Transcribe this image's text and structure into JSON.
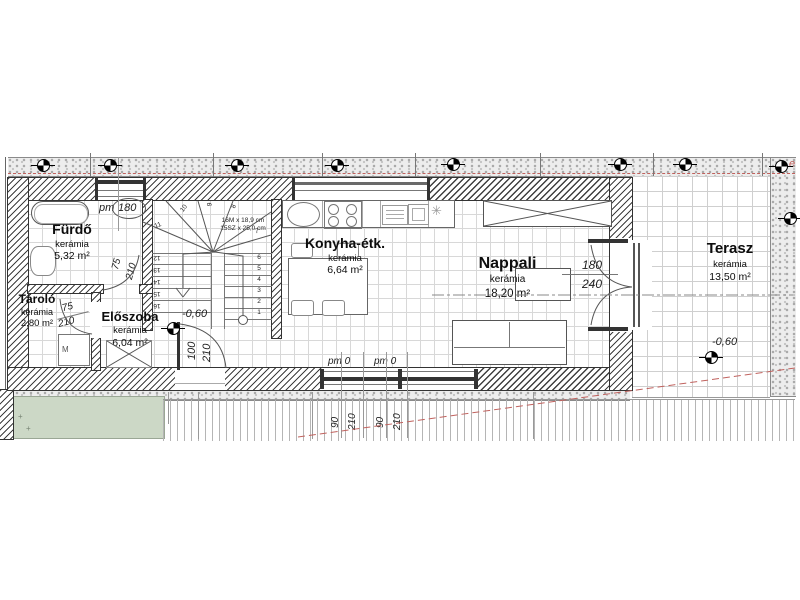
{
  "rooms": {
    "furdo": {
      "name": "Fürdő",
      "material": "kerámia",
      "area": "5,32 m²"
    },
    "tarolo": {
      "name": "Tároló",
      "material": "kerámia",
      "area": "2,80 m²"
    },
    "eloszoba": {
      "name": "Előszoba",
      "material": "kerámia",
      "area": "6,04 m²"
    },
    "konyha": {
      "name": "Konyha-étk.",
      "material": "kerámia",
      "area": "6,64 m²"
    },
    "nappali": {
      "name": "Nappali",
      "material": "kerámia",
      "area": "18,20 m²"
    },
    "terasz": {
      "name": "Terasz",
      "material": "kerámia",
      "area": "13,50 m²"
    }
  },
  "stairs": {
    "spec_line1": "16M x 18,9 cm",
    "spec_line2": "15SZ x 25,0 cm",
    "right_numbers": [
      "6",
      "5",
      "4",
      "3",
      "2",
      "1"
    ],
    "left_numbers": [
      "12",
      "13",
      "14",
      "15",
      "16"
    ],
    "winder_numbers": [
      "7",
      "8",
      "9",
      "10",
      "11"
    ]
  },
  "dimensions": {
    "top_window": {
      "prefix": "pm",
      "value": "180"
    },
    "bathroom_door": {
      "width": "75",
      "height": "210"
    },
    "storage_door": {
      "width": "75",
      "height": "210"
    },
    "entry_door": {
      "width": "100",
      "height": "210"
    },
    "window1": {
      "parapet": "pm 0",
      "width": "90",
      "height": "210"
    },
    "window2": {
      "parapet": "pm 0",
      "width": "90",
      "height": "210"
    },
    "terrace_door": {
      "width": "180",
      "height": "240"
    }
  },
  "elevations": {
    "stair": "-0,60",
    "terrace": "-0,60"
  },
  "annotations": {
    "washing_machine": "M",
    "plot_letter": "e",
    "plus_mark": "+"
  },
  "icons": {
    "fridge_symbol": "✳"
  }
}
